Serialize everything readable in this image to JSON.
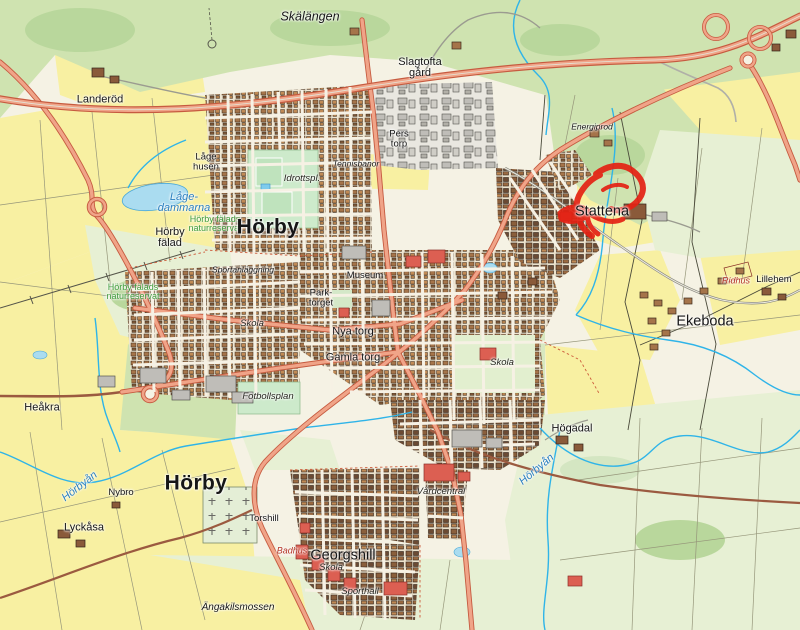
{
  "map": {
    "region_name": "Hörby tätort med omnejd",
    "annotation": {
      "name": "red-marker-scribble",
      "color": "#e42113",
      "location_label": "Stattena"
    },
    "palette": {
      "field_yellow": "#f8f0a2",
      "forest_green": "#cfe3b0",
      "open_green": "#e7f0d4",
      "urban_base": "#f3ecdd",
      "water_fill": "#aadcf0",
      "stream_blue": "#2fb4e8",
      "road_fill": "#f0a488",
      "road_casing": "#c65b40",
      "minor_road_brown": "#9b5a40",
      "building_brown": "#a5744a",
      "building_red": "#dc5f52",
      "building_gray": "#bfbdb8"
    },
    "labels": [
      {
        "id": "skalangen",
        "text": "Skälängen",
        "x": 310,
        "y": 17,
        "style": "terrain-lg"
      },
      {
        "id": "landerod",
        "text": "Landeröd",
        "x": 100,
        "y": 100,
        "style": "place"
      },
      {
        "id": "slagtofta-gard",
        "text": "Slagtofta\ngård",
        "x": 420,
        "y": 68,
        "style": "place"
      },
      {
        "id": "pers-torp",
        "text": "Pers\ntorp",
        "x": 399,
        "y": 139,
        "style": "place-sm"
      },
      {
        "id": "lage-husen",
        "text": "Låge\nhusen",
        "x": 206,
        "y": 162,
        "style": "place-sm"
      },
      {
        "id": "energiprod",
        "text": "Energiprod",
        "x": 592,
        "y": 127,
        "style": "terrain-sm"
      },
      {
        "id": "lage-dammarna",
        "text": "Låge-\ndammarna",
        "x": 184,
        "y": 203,
        "style": "water"
      },
      {
        "id": "horby-falads-naturreservat-n",
        "text": "Hörby fälads\nnaturreservat",
        "x": 215,
        "y": 224,
        "style": "nature"
      },
      {
        "id": "horby-falad",
        "text": "Hörby\nfälad",
        "x": 170,
        "y": 238,
        "style": "place"
      },
      {
        "id": "horby-centrum",
        "text": "Hörby",
        "x": 268,
        "y": 227,
        "style": "place-xl"
      },
      {
        "id": "stattena",
        "text": "Stattena",
        "x": 602,
        "y": 212,
        "style": "place-lg"
      },
      {
        "id": "ridhus",
        "text": "Ridhus",
        "x": 736,
        "y": 281,
        "style": "poi-red"
      },
      {
        "id": "lillehem",
        "text": "Lillehem",
        "x": 774,
        "y": 280,
        "style": "place-sm"
      },
      {
        "id": "ekeboda",
        "text": "Ekeboda",
        "x": 705,
        "y": 322,
        "style": "place-lg"
      },
      {
        "id": "idrottsplats",
        "text": "Idrottspl.",
        "x": 302,
        "y": 179,
        "style": "poi"
      },
      {
        "id": "tennisbanor",
        "text": "Tennisbanor",
        "x": 356,
        "y": 164,
        "style": "terrain-sm"
      },
      {
        "id": "sportanlaggning",
        "text": "Sportanläggning",
        "x": 243,
        "y": 270,
        "style": "terrain-sm"
      },
      {
        "id": "museum",
        "text": "Museum",
        "x": 365,
        "y": 276,
        "style": "place-sm"
      },
      {
        "id": "parktorget",
        "text": "Park-\ntorget",
        "x": 321,
        "y": 298,
        "style": "place-sm"
      },
      {
        "id": "nya-torg",
        "text": "Nya torg",
        "x": 353,
        "y": 332,
        "style": "place"
      },
      {
        "id": "gamla-torg",
        "text": "Gamla torg",
        "x": 353,
        "y": 358,
        "style": "place"
      },
      {
        "id": "skola-vast",
        "text": "Skola",
        "x": 252,
        "y": 324,
        "style": "poi"
      },
      {
        "id": "fotbollsplan",
        "text": "Fotbollsplan",
        "x": 268,
        "y": 397,
        "style": "poi"
      },
      {
        "id": "skola-ost",
        "text": "Skola",
        "x": 502,
        "y": 363,
        "style": "poi"
      },
      {
        "id": "heakra",
        "text": "Heåkra",
        "x": 42,
        "y": 408,
        "style": "place"
      },
      {
        "id": "horbyan-vast",
        "text": "Hörbyån",
        "x": 80,
        "y": 487,
        "style": "water",
        "rotate": -38
      },
      {
        "id": "nybro",
        "text": "Nybro",
        "x": 121,
        "y": 493,
        "style": "place-sm"
      },
      {
        "id": "lyckasa",
        "text": "Lyckåsa",
        "x": 84,
        "y": 528,
        "style": "place"
      },
      {
        "id": "horby-syd",
        "text": "Hörby",
        "x": 196,
        "y": 483,
        "style": "place-xl"
      },
      {
        "id": "torshill",
        "text": "Torshill",
        "x": 264,
        "y": 519,
        "style": "place-sm"
      },
      {
        "id": "badhus",
        "text": "Badhus",
        "x": 292,
        "y": 551,
        "style": "poi-red"
      },
      {
        "id": "georgshill",
        "text": "Georgshill",
        "x": 343,
        "y": 556,
        "style": "place-lg"
      },
      {
        "id": "skola-syd",
        "text": "Skola",
        "x": 331,
        "y": 568,
        "style": "poi"
      },
      {
        "id": "sporthall",
        "text": "Sporthall",
        "x": 360,
        "y": 592,
        "style": "poi"
      },
      {
        "id": "angakilsmossen",
        "text": "Ängakilsmossen",
        "x": 238,
        "y": 608,
        "style": "terrain"
      },
      {
        "id": "hogadal",
        "text": "Högadal",
        "x": 572,
        "y": 429,
        "style": "place"
      },
      {
        "id": "horbyan-ost",
        "text": "Hörbyån",
        "x": 537,
        "y": 470,
        "style": "water",
        "rotate": -40
      },
      {
        "id": "vardcentral",
        "text": "Vårdcentral",
        "x": 441,
        "y": 492,
        "style": "poi"
      },
      {
        "id": "horby-falads-naturreservat-v",
        "text": "Hörby fälads\nnaturreservat",
        "x": 133,
        "y": 292,
        "style": "nature"
      }
    ]
  }
}
